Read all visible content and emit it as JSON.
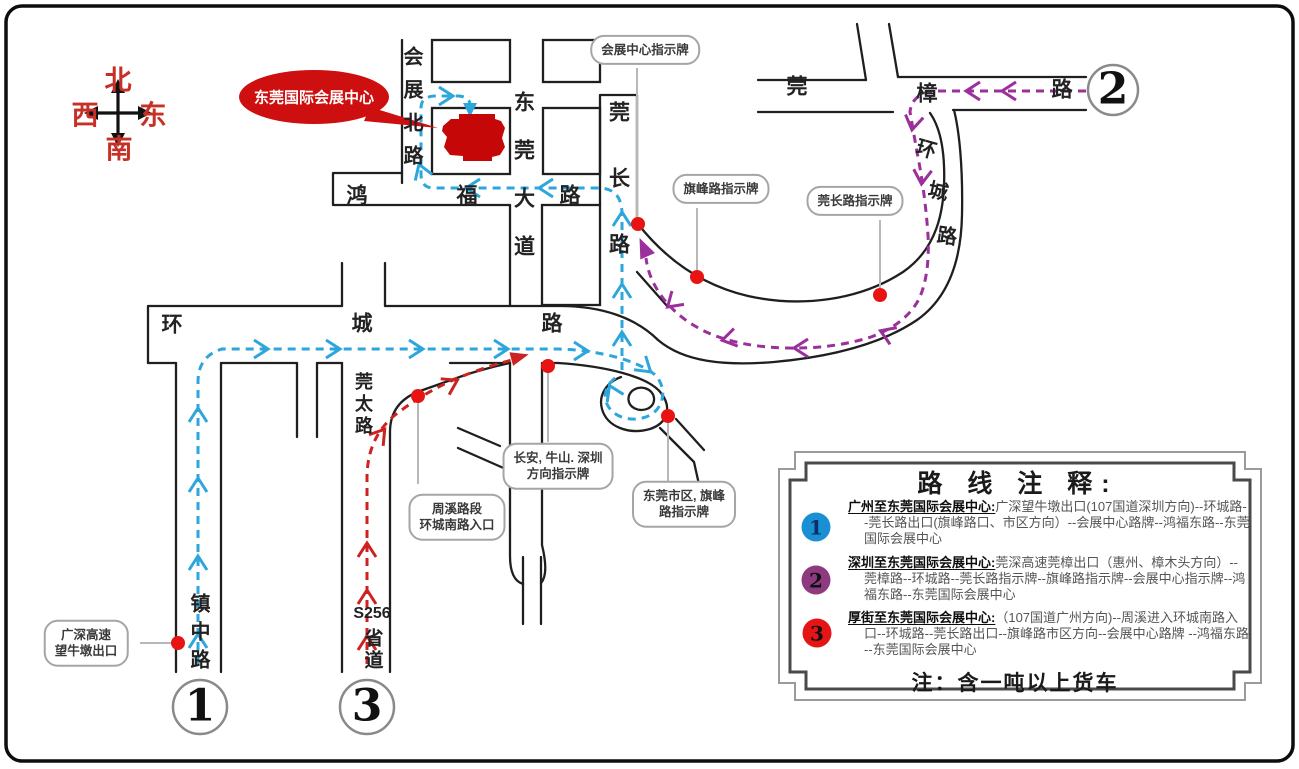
{
  "colors": {
    "route1_blue": "#2ca6db",
    "route2_purple": "#9b2f9b",
    "route3_red": "#cd2222",
    "marker_dot_red": "#e81414",
    "destination_red": "#ce0f0f",
    "legend_circle1_blue": "#1a8fd1",
    "legend_circle2_purple": "#8e3a80",
    "legend_circle3_red": "#e51515"
  },
  "compass": {
    "north": "北",
    "south": "南",
    "west": "西",
    "east": "东"
  },
  "destination": {
    "label": "东莞国际会展中心"
  },
  "road_labels": {
    "huizhan_north": "会展北路",
    "dongguan_avenue": "东莞大道",
    "guanchang_road": "莞长路",
    "hongfu_1": "鸿",
    "hongfu_2": "福",
    "hongfu_3": "路",
    "huancheng_w_1": "环",
    "huancheng_w_2": "城",
    "huancheng_w_3": "路",
    "guantai_road": "莞太路",
    "zhenzhong_road": "镇中路",
    "s256_line1": "S256",
    "s256_line2": "省道",
    "guanzhang_1": "莞",
    "guanzhang_2": "樟",
    "guanzhang_3": "路",
    "huancheng_ne_1": "环",
    "huancheng_ne_2": "城",
    "huancheng_ne_3": "路"
  },
  "signs": {
    "huizhan_center": "会展中心指示牌",
    "qifeng": "旗峰路指示牌",
    "guanchang": "莞长路指示牌",
    "changan_line1": "长安, 牛山. 深圳",
    "changan_line2": "方向指示牌",
    "zhouxi_line1": "周溪路段",
    "zhouxi_line2": "环城南路入口",
    "shiqu_line1": "东莞市区, 旗峰",
    "shiqu_line2": "路指示牌",
    "gaosu_line1": "广深高速",
    "gaosu_line2": "望牛墩出口"
  },
  "map_markers": {
    "route1": "1",
    "route2": "2",
    "route3": "3"
  },
  "legend": {
    "title": "路 线 注 释:",
    "entries": [
      {
        "num": "1",
        "heading": "广州至东莞国际会展中心:",
        "desc": "广深望牛墩出口(107国道深圳方向)--环城路--莞长路出口(旗峰路口、市区方向）--会展中心路牌--鸿福东路--东莞国际会展中心"
      },
      {
        "num": "2",
        "heading": "深圳至东莞国际会展中心:",
        "desc": "莞深高速莞樟出口（惠州、樟木头方向）--莞樟路--环城路--莞长路指示牌--旗峰路指示牌--会展中心指示牌--鸿福东路--东莞国际会展中心"
      },
      {
        "num": "3",
        "heading": "厚街至东莞国际会展中心:",
        "desc": "（107国道广州方向)--周溪进入环城南路入口--环城路--莞长路出口--旗峰路市区方向--会展中心路牌 --鸿福东路 --东莞国际会展中心"
      }
    ],
    "note": "注：含一吨以上货车"
  }
}
